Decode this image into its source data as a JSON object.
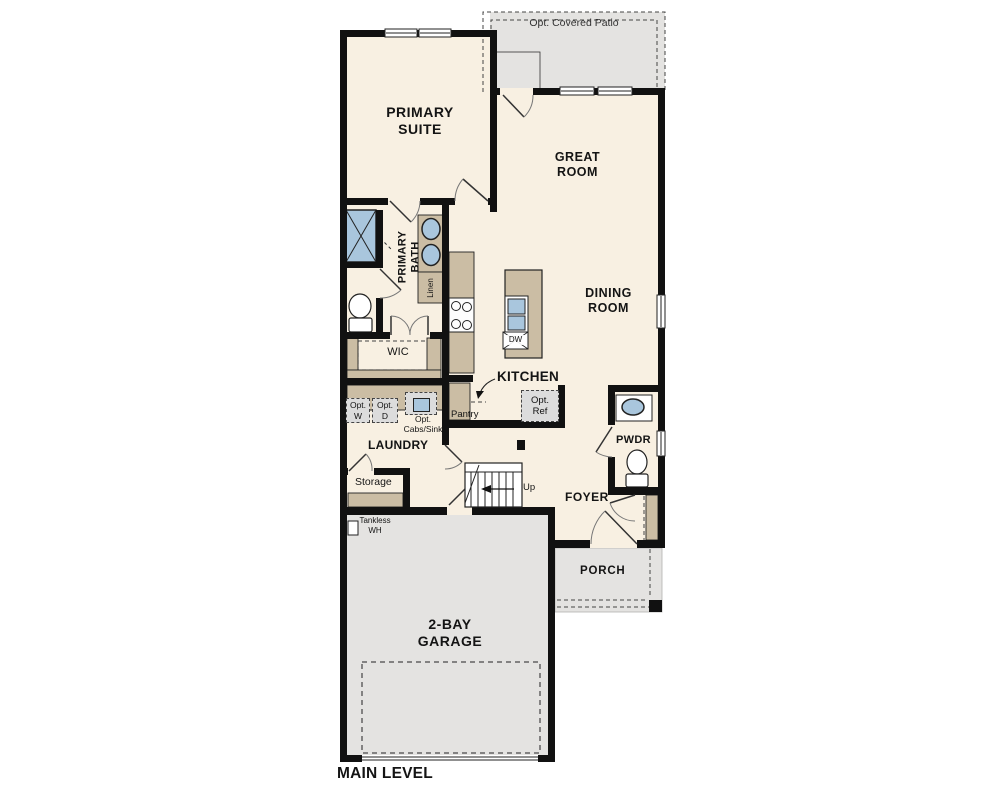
{
  "page": {
    "background": "#ffffff",
    "caption": "MAIN LEVEL"
  },
  "colors": {
    "wall": "#111111",
    "floor": "#f8f0e2",
    "concrete_gray": "#e4e3e1",
    "cabinet_tan": "#cbbda4",
    "fixture_blue": "#a9c6dd",
    "option_gray": "#dcdcdc",
    "line": "#333333"
  },
  "labels": {
    "patio": "Opt. Covered Patio",
    "primary_suite": {
      "l1": "PRIMARY",
      "l2": "SUITE"
    },
    "great_room": {
      "l1": "GREAT",
      "l2": "ROOM"
    },
    "dining_room": {
      "l1": "DINING",
      "l2": "ROOM"
    },
    "primary_bath": {
      "l1": "PRIMARY",
      "l2": "BATH"
    },
    "linen": "Linen",
    "wic": "WIC",
    "kitchen": "KITCHEN",
    "pantry": "Pantry",
    "dw": "DW",
    "opt_ref": {
      "l1": "Opt.",
      "l2": "Ref"
    },
    "opt_w": {
      "l1": "Opt.",
      "l2": "W"
    },
    "opt_d": {
      "l1": "Opt.",
      "l2": "D"
    },
    "opt_cabs": {
      "l1": "Opt.",
      "l2": "Cabs/Sink"
    },
    "laundry": "LAUNDRY",
    "storage": "Storage",
    "up": "Up",
    "foyer": "FOYER",
    "pwdr": "PWDR",
    "porch": "PORCH",
    "garage": {
      "l1": "2-BAY",
      "l2": "GARAGE"
    },
    "tankless": {
      "l1": "Tankless",
      "l2": "WH"
    },
    "main_level": "MAIN LEVEL"
  },
  "fixtures": [
    "shower",
    "vanity-double-sink",
    "primary-toilet",
    "linen-closet",
    "range-cooktop",
    "island-sink",
    "dishwasher",
    "optional-refrigerator",
    "optional-washer",
    "optional-dryer",
    "optional-cabinets-sink",
    "powder-vanity-sink",
    "powder-toilet",
    "stairs-up",
    "tankless-water-heater",
    "garage-door",
    "front-door",
    "patio-door",
    "windows",
    "porch-post"
  ]
}
